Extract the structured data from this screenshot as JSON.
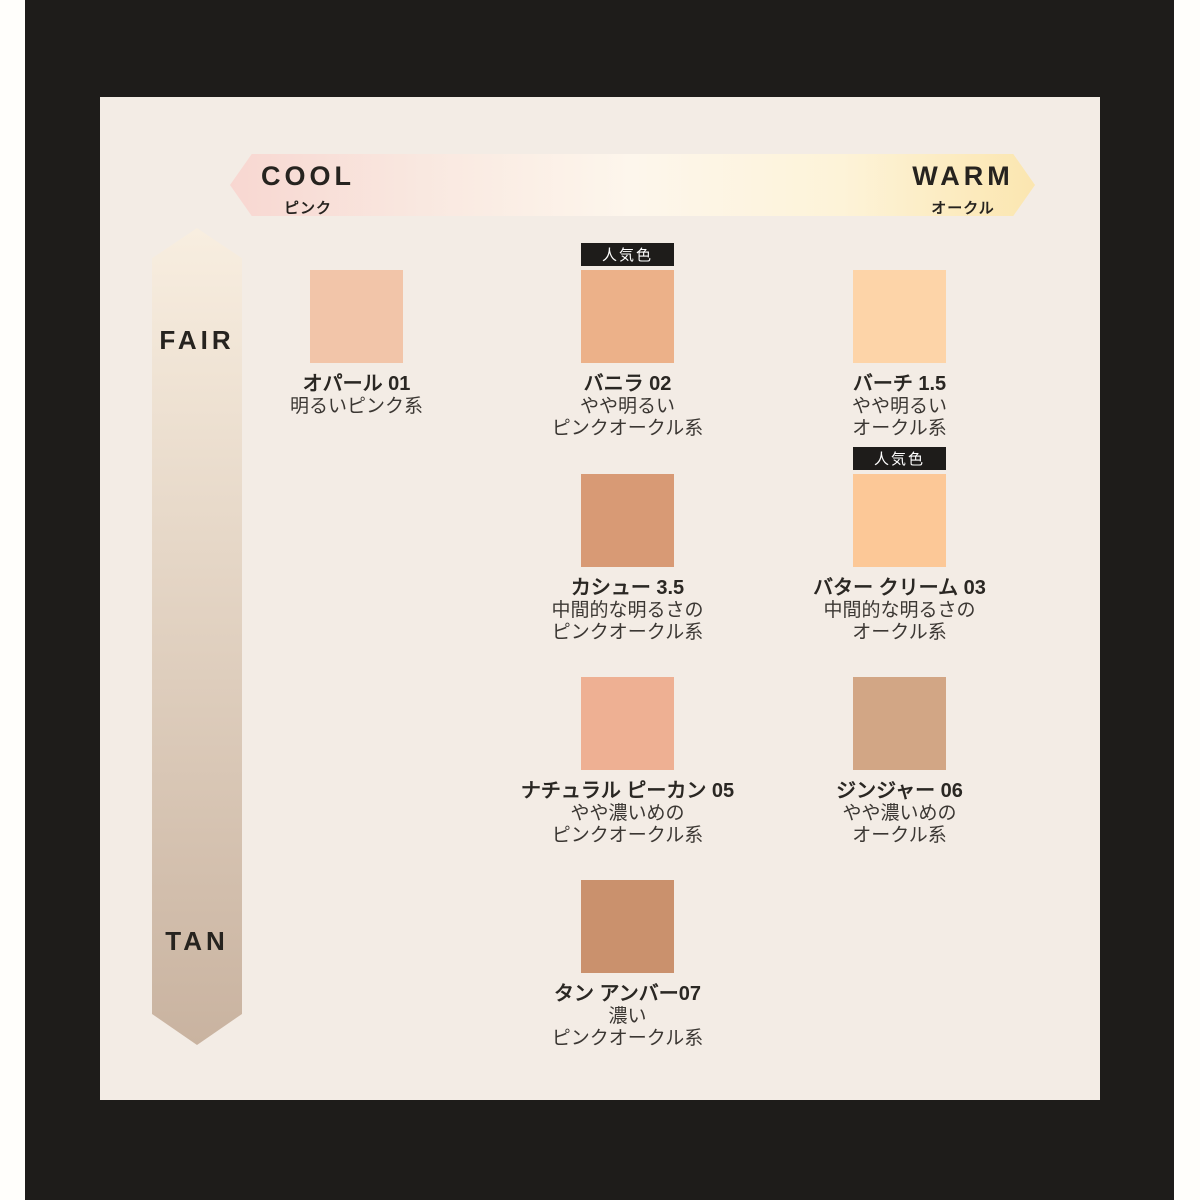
{
  "axis_horizontal": {
    "left_label": "COOL",
    "left_sub": "ピンク",
    "right_label": "WARM",
    "right_sub": "オークル"
  },
  "axis_vertical": {
    "top_label": "FAIR",
    "bottom_label": "TAN"
  },
  "popular_badge": "人気色",
  "colors": {
    "page": "#fffefb",
    "frame": "#1e1c1a",
    "panel": "#f3ece5",
    "text_dark": "#26231f",
    "arrow_v_top": "#f8eee0",
    "arrow_v_bottom": "#c9b3a0",
    "arrow_h_stops": [
      "#f8d7d1",
      "#f9e8e0",
      "#fdf6ec",
      "#fdf3d8",
      "#fbe6b0"
    ]
  },
  "shades": [
    {
      "name": "オパール 01",
      "desc": [
        "明るいピンク系"
      ],
      "color": "#f2c5a9",
      "col": 1,
      "row": 1,
      "popular": false
    },
    {
      "name": "バニラ 02",
      "desc": [
        "やや明るい",
        "ピンクオークル系"
      ],
      "color": "#ecb189",
      "col": 2,
      "row": 1,
      "popular": true
    },
    {
      "name": "バーチ 1.5",
      "desc": [
        "やや明るい",
        "オークル系"
      ],
      "color": "#fdd4a8",
      "col": 3,
      "row": 1,
      "popular": false
    },
    {
      "name": "カシュー 3.5",
      "desc": [
        "中間的な明るさの",
        "ピンクオークル系"
      ],
      "color": "#d89a75",
      "col": 2,
      "row": 2,
      "popular": false
    },
    {
      "name": "バター クリーム 03",
      "desc": [
        "中間的な明るさの",
        "オークル系"
      ],
      "color": "#fcc897",
      "col": 3,
      "row": 2,
      "popular": true
    },
    {
      "name": "ナチュラル ピーカン 05",
      "desc": [
        "やや濃いめの",
        "ピンクオークル系"
      ],
      "color": "#eeb093",
      "col": 2,
      "row": 3,
      "popular": false
    },
    {
      "name": "ジンジャー 06",
      "desc": [
        "やや濃いめの",
        "オークル系"
      ],
      "color": "#d2a685",
      "col": 3,
      "row": 3,
      "popular": false
    },
    {
      "name": "タン アンバー07",
      "desc": [
        "濃い",
        "ピンクオークル系"
      ],
      "color": "#ca916d",
      "col": 2,
      "row": 4,
      "popular": false
    }
  ]
}
